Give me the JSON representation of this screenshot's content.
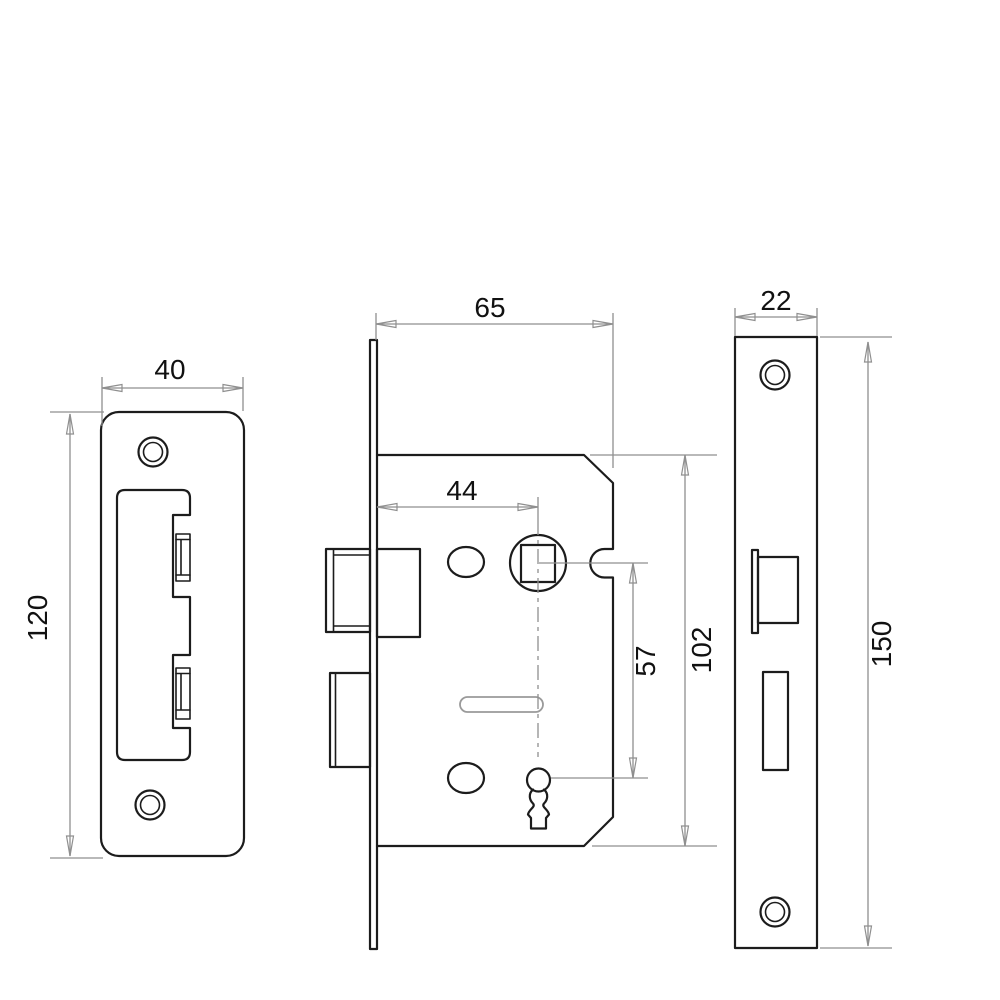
{
  "colors": {
    "background": "#ffffff",
    "outline": "#1c1c1c",
    "dimension": "#8f8f8f",
    "slot": "#9a9a9a",
    "label": "#111111"
  },
  "views": {
    "strike_plate": {
      "width_label": "40",
      "height_label": "120"
    },
    "lock_case": {
      "depth_label": "65",
      "backset_label": "44",
      "spindle_to_keyhole_label": "57",
      "height_label": "102"
    },
    "faceplate": {
      "width_label": "22",
      "height_label": "150"
    }
  }
}
